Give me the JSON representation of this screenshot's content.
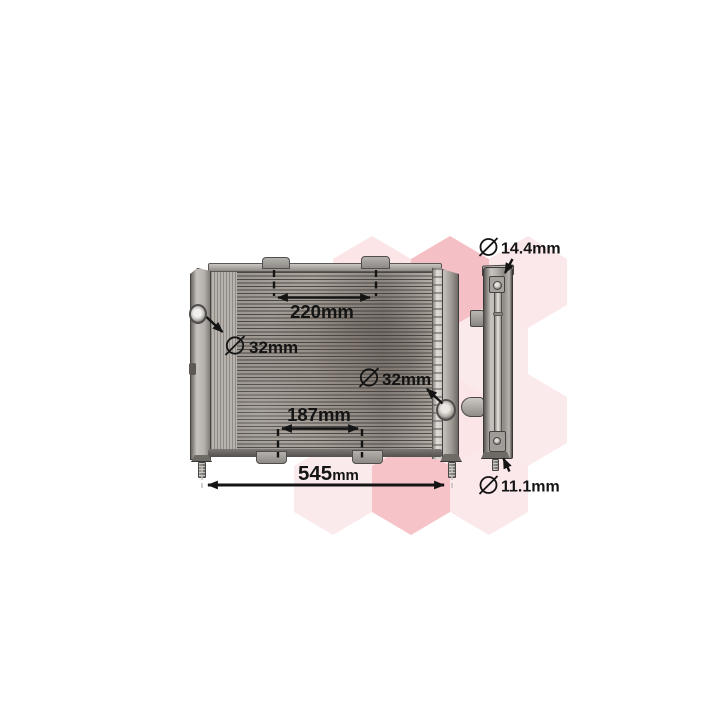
{
  "image": {
    "description": "Radiator cooling module product photo with dimension callouts, front view and side view, over a pink hexagon watermark",
    "background_color": "#ffffff"
  },
  "watermark": {
    "shape": "hexagon-honeycomb",
    "color": "#e2505f"
  },
  "views": {
    "front": {
      "name": "radiator-front-view"
    },
    "side": {
      "name": "radiator-side-view"
    }
  },
  "annotations": {
    "color": "#141414",
    "width_220": {
      "label": "220mm"
    },
    "inlet_left": {
      "symbol": "diameter",
      "label": "32mm"
    },
    "outlet_right": {
      "symbol": "diameter",
      "label": "32mm"
    },
    "width_187": {
      "label": "187mm"
    },
    "overall_width": {
      "value": "545",
      "unit": "mm"
    },
    "pipe_top": {
      "symbol": "diameter",
      "label": "14.4mm"
    },
    "pipe_bottom": {
      "symbol": "diameter",
      "label": "11.1mm"
    }
  }
}
